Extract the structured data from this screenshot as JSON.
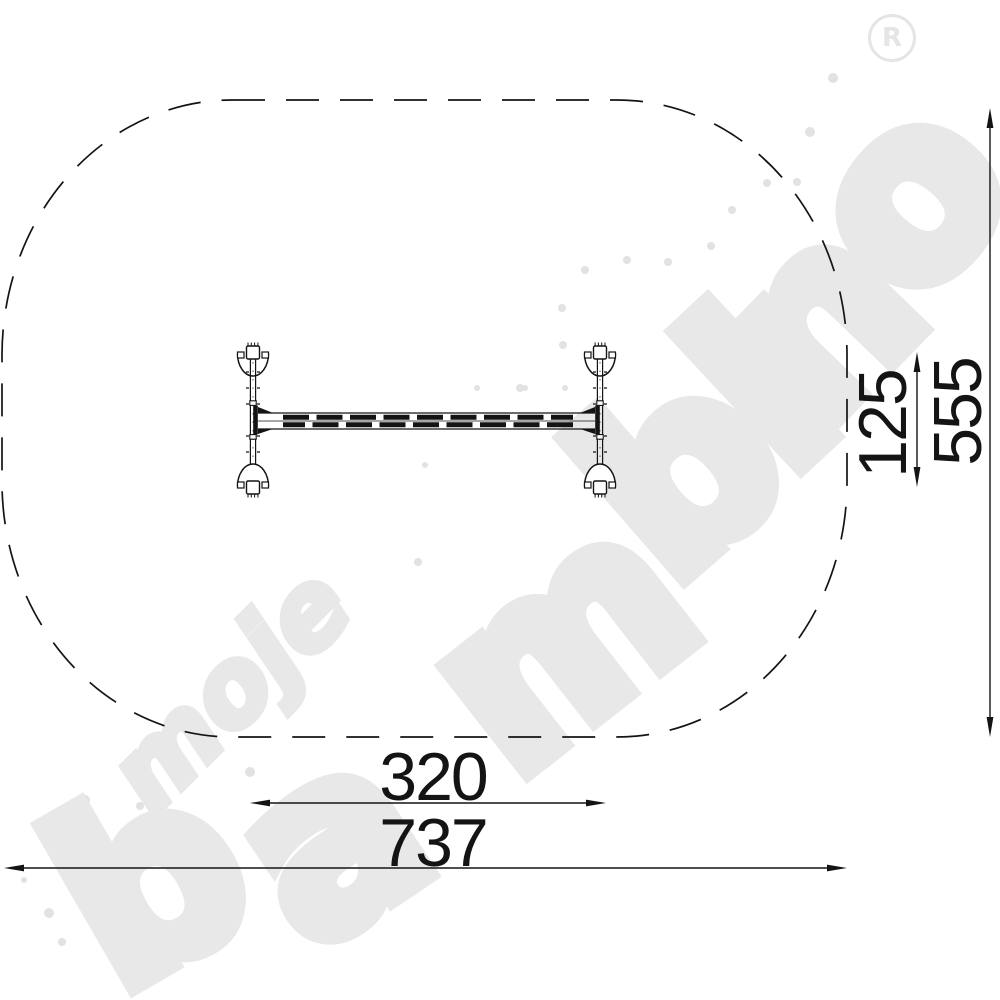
{
  "watermark": {
    "word_small": "moje",
    "word_large": "bambino",
    "registered_mark": "R",
    "color": "#e8e8e8"
  },
  "dimensions": {
    "equipment_width": "320",
    "zone_width": "737",
    "equipment_depth": "125",
    "zone_depth": "555"
  },
  "drawing": {
    "view": "plan view of beam equipment with dashed safety-zone outline"
  },
  "colors": {
    "line": "#141414",
    "watermark": "#e8e8e8",
    "background": "#ffffff"
  }
}
